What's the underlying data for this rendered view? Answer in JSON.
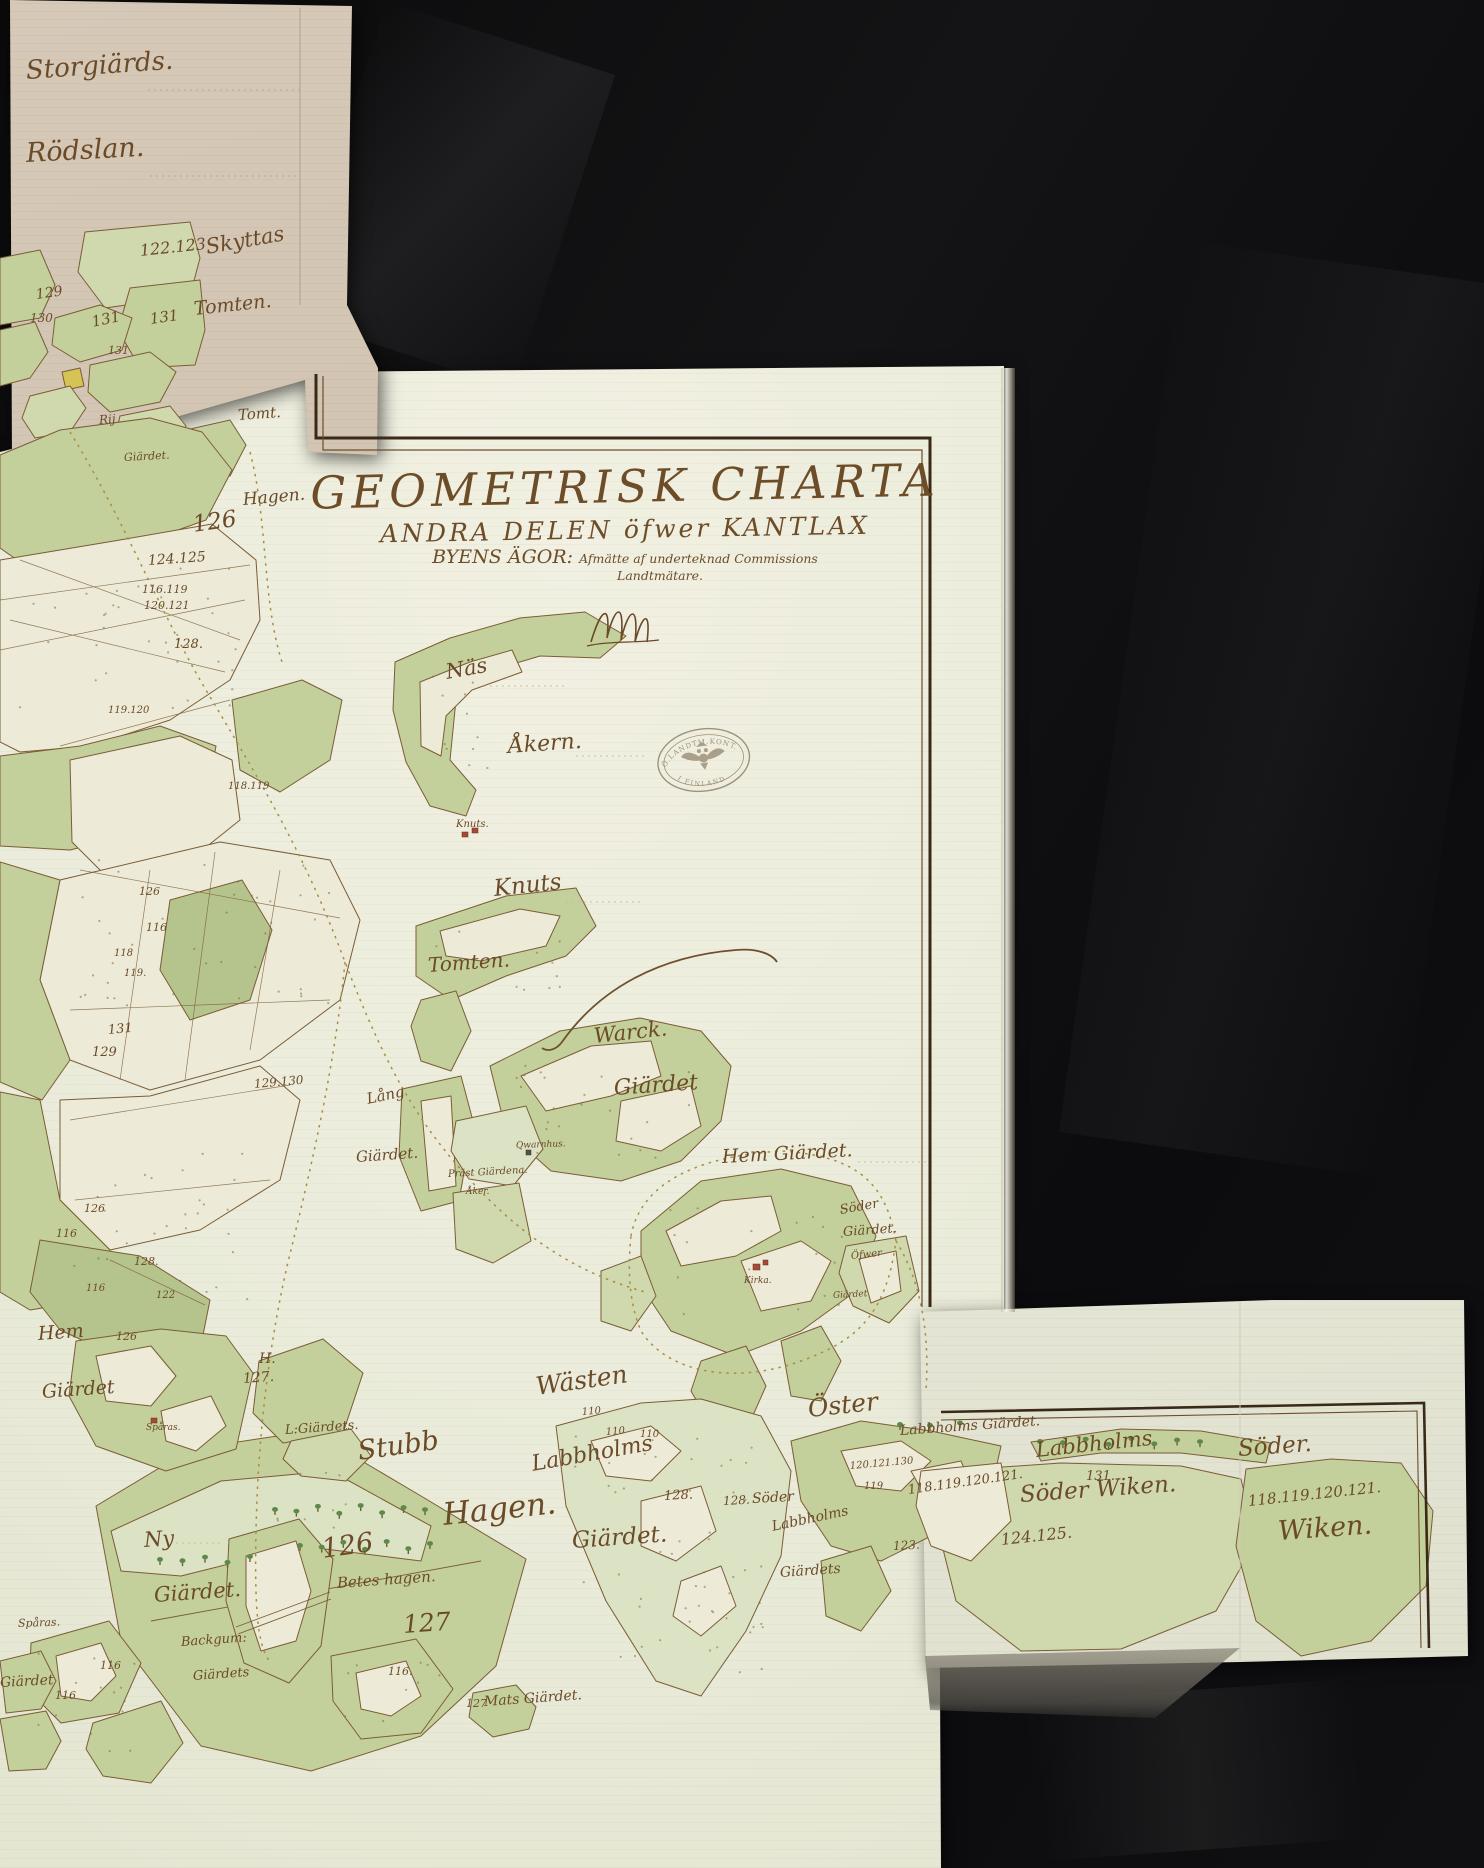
{
  "title_block": {
    "title": "GEOMETRISK CHARTA",
    "subtitle": "ANDRA DELEN öfwer KANTLAX",
    "line3_left": "BYENS ÄGOR:",
    "line3_right": "Afmätte af underteknad Commissions",
    "line4": "Landtmätare."
  },
  "stamp": {
    "arc_top": "Ö.LANDTM.KONT.",
    "arc_bottom": "I FINLAND"
  },
  "labels": [
    {
      "id": "storgiards",
      "t": "Storgiärds.",
      "x": 26,
      "y": 58,
      "s": 26,
      "r": -4
    },
    {
      "id": "rodslan",
      "t": "Rödslan.",
      "x": 26,
      "y": 140,
      "s": 27,
      "r": -3
    },
    {
      "id": "num-122-123",
      "t": "122.123",
      "x": 140,
      "y": 243,
      "s": 16,
      "r": -6
    },
    {
      "id": "skyttas",
      "t": "Skyttas",
      "x": 206,
      "y": 237,
      "s": 21,
      "r": -10
    },
    {
      "id": "num-129-tan",
      "t": "129",
      "x": 36,
      "y": 288,
      "s": 14,
      "r": -8
    },
    {
      "id": "num-130-tan",
      "t": "130",
      "x": 30,
      "y": 312,
      "s": 12,
      "r": 0
    },
    {
      "id": "num-131-a",
      "t": "131",
      "x": 92,
      "y": 315,
      "s": 15,
      "r": -12
    },
    {
      "id": "num-131-b",
      "t": "131",
      "x": 150,
      "y": 312,
      "s": 15,
      "r": -8
    },
    {
      "id": "num-131-c",
      "t": "131",
      "x": 108,
      "y": 345,
      "s": 11,
      "r": 0
    },
    {
      "id": "tomten-tan",
      "t": "Tomten.",
      "x": 194,
      "y": 300,
      "s": 19,
      "r": -6
    },
    {
      "id": "rij",
      "t": "Rij",
      "x": 99,
      "y": 414,
      "s": 12,
      "r": -5
    },
    {
      "id": "giardet-tan",
      "t": "Giärdet.",
      "x": 124,
      "y": 452,
      "s": 11,
      "r": -3
    },
    {
      "id": "tomt",
      "t": "Tomt.",
      "x": 238,
      "y": 408,
      "s": 15,
      "r": -4
    },
    {
      "id": "hagen-left",
      "t": "Hagen.",
      "x": 243,
      "y": 492,
      "s": 17,
      "r": -5
    },
    {
      "id": "num-126-big-cluster",
      "t": "126",
      "x": 193,
      "y": 514,
      "s": 23,
      "r": -8
    },
    {
      "id": "num-124-125",
      "t": "124.125",
      "x": 148,
      "y": 554,
      "s": 14,
      "r": -4
    },
    {
      "id": "num-116-119",
      "t": "116.119",
      "x": 142,
      "y": 584,
      "s": 11,
      "r": 0
    },
    {
      "id": "num-120-121",
      "t": "120.121",
      "x": 144,
      "y": 600,
      "s": 11,
      "r": 0
    },
    {
      "id": "num-128-c",
      "t": "128.",
      "x": 174,
      "y": 638,
      "s": 13,
      "r": 0
    },
    {
      "id": "num-119-120",
      "t": "119.120",
      "x": 108,
      "y": 706,
      "s": 10,
      "r": 0
    },
    {
      "id": "num-118-119",
      "t": "118.119",
      "x": 228,
      "y": 782,
      "s": 10,
      "r": 0
    },
    {
      "id": "num-126-b",
      "t": "126",
      "x": 139,
      "y": 886,
      "s": 11,
      "r": 0
    },
    {
      "id": "num-116-a",
      "t": "116",
      "x": 146,
      "y": 922,
      "s": 11,
      "r": 0
    },
    {
      "id": "num-118-a",
      "t": "118",
      "x": 114,
      "y": 949,
      "s": 10,
      "r": 0
    },
    {
      "id": "num-119-a",
      "t": "119.",
      "x": 124,
      "y": 969,
      "s": 10,
      "r": 0
    },
    {
      "id": "num-131-d",
      "t": "131",
      "x": 108,
      "y": 1024,
      "s": 13,
      "r": -5
    },
    {
      "id": "num-129-b",
      "t": "129",
      "x": 92,
      "y": 1046,
      "s": 13,
      "r": 0
    },
    {
      "id": "num-129-130",
      "t": "129.130",
      "x": 254,
      "y": 1078,
      "s": 12,
      "r": -5
    },
    {
      "id": "num-126-c",
      "t": "126",
      "x": 84,
      "y": 1203,
      "s": 11,
      "r": 0
    },
    {
      "id": "num-116-b",
      "t": "116",
      "x": 56,
      "y": 1228,
      "s": 11,
      "r": 0
    },
    {
      "id": "num-128-d",
      "t": "128.",
      "x": 134,
      "y": 1256,
      "s": 11,
      "r": 0
    },
    {
      "id": "num-116-c",
      "t": "116",
      "x": 86,
      "y": 1284,
      "s": 10,
      "r": 0
    },
    {
      "id": "num-122-a",
      "t": "122",
      "x": 156,
      "y": 1291,
      "s": 10,
      "r": 0
    },
    {
      "id": "num-126-d",
      "t": "126",
      "x": 116,
      "y": 1331,
      "s": 11,
      "r": 0
    },
    {
      "id": "nas",
      "t": "Näs",
      "x": 446,
      "y": 662,
      "s": 21,
      "r": -10
    },
    {
      "id": "akern",
      "t": "Åkern.",
      "x": 508,
      "y": 736,
      "s": 22,
      "r": -4
    },
    {
      "id": "knuts-small",
      "t": "Knuts.",
      "x": 456,
      "y": 820,
      "s": 10,
      "r": 0
    },
    {
      "id": "knuts",
      "t": "Knuts",
      "x": 494,
      "y": 878,
      "s": 23,
      "r": -6
    },
    {
      "id": "tomten-main",
      "t": "Tomten.",
      "x": 428,
      "y": 955,
      "s": 20,
      "r": -4
    },
    {
      "id": "warck",
      "t": "Warck.",
      "x": 594,
      "y": 1026,
      "s": 21,
      "r": -6
    },
    {
      "id": "warck-giardet",
      "t": "Giärdet",
      "x": 614,
      "y": 1078,
      "s": 22,
      "r": -4
    },
    {
      "id": "lang",
      "t": "Lång",
      "x": 367,
      "y": 1092,
      "s": 15,
      "r": -12
    },
    {
      "id": "lang-giardet",
      "t": "Giärdet.",
      "x": 356,
      "y": 1150,
      "s": 15,
      "r": -4
    },
    {
      "id": "qwarnhus",
      "t": "Qwarnhus.",
      "x": 516,
      "y": 1142,
      "s": 9,
      "r": -2
    },
    {
      "id": "prast-giardena",
      "t": "Präst Giärdena.",
      "x": 448,
      "y": 1170,
      "s": 10,
      "r": -3
    },
    {
      "id": "aker-small",
      "t": "Åker.",
      "x": 466,
      "y": 1188,
      "s": 9,
      "r": 0
    },
    {
      "id": "hem-giardet",
      "t": "Hem Giärdet.",
      "x": 722,
      "y": 1148,
      "s": 19,
      "r": -3
    },
    {
      "id": "soder-giardet-1",
      "t": "Söder",
      "x": 840,
      "y": 1204,
      "s": 13,
      "r": -10
    },
    {
      "id": "soder-giardet-2",
      "t": "Giärdet.",
      "x": 843,
      "y": 1226,
      "s": 13,
      "r": -4
    },
    {
      "id": "ofwer",
      "t": "Öfwer",
      "x": 851,
      "y": 1252,
      "s": 10,
      "r": -6
    },
    {
      "id": "ofwer-giardet",
      "t": "Giärdet",
      "x": 833,
      "y": 1292,
      "s": 9,
      "r": -3
    },
    {
      "id": "kirka",
      "t": "Kirka.",
      "x": 744,
      "y": 1277,
      "s": 9,
      "r": 0
    },
    {
      "id": "wasten",
      "t": "Wästen",
      "x": 536,
      "y": 1374,
      "s": 25,
      "r": -8
    },
    {
      "id": "oster",
      "t": "Öster",
      "x": 808,
      "y": 1396,
      "s": 25,
      "r": -6
    },
    {
      "id": "labbholms-w",
      "t": "Labbholms",
      "x": 532,
      "y": 1454,
      "s": 22,
      "r": -10
    },
    {
      "id": "labbholms-w-giardet",
      "t": "Giärdet.",
      "x": 572,
      "y": 1530,
      "s": 23,
      "r": -4
    },
    {
      "id": "soder-mid",
      "t": "Söder",
      "x": 752,
      "y": 1492,
      "s": 14,
      "r": -3
    },
    {
      "id": "labbholms-mid",
      "t": "Labbholms",
      "x": 772,
      "y": 1520,
      "s": 14,
      "r": -12
    },
    {
      "id": "giardets-mid",
      "t": "Giärdets",
      "x": 780,
      "y": 1566,
      "s": 14,
      "r": -4
    },
    {
      "id": "num-128-a",
      "t": "128.",
      "x": 664,
      "y": 1490,
      "s": 13,
      "r": -3
    },
    {
      "id": "num-128-b",
      "t": "128.",
      "x": 723,
      "y": 1495,
      "s": 12,
      "r": -3
    },
    {
      "id": "num-123-a",
      "t": "123.",
      "x": 893,
      "y": 1540,
      "s": 12,
      "r": -3
    },
    {
      "id": "num-110-a",
      "t": "110",
      "x": 582,
      "y": 1408,
      "s": 10,
      "r": -5
    },
    {
      "id": "num-110-b",
      "t": "110",
      "x": 606,
      "y": 1428,
      "s": 10,
      "r": -5
    },
    {
      "id": "num-110-c",
      "t": "110",
      "x": 640,
      "y": 1430,
      "s": 10,
      "r": 0
    },
    {
      "id": "num-oster-1",
      "t": "120.121.130",
      "x": 850,
      "y": 1462,
      "s": 10,
      "r": -5
    },
    {
      "id": "num-oster-2",
      "t": "119",
      "x": 864,
      "y": 1482,
      "s": 10,
      "r": 0
    },
    {
      "id": "stubb",
      "t": "Stubb",
      "x": 358,
      "y": 1438,
      "s": 27,
      "r": -8
    },
    {
      "id": "l-giardets",
      "t": "L:Giärdets.",
      "x": 285,
      "y": 1424,
      "s": 13,
      "r": -4
    },
    {
      "id": "hagen-big",
      "t": "Hagen.",
      "x": 443,
      "y": 1500,
      "s": 31,
      "r": -6
    },
    {
      "id": "num-126-big",
      "t": "126",
      "x": 322,
      "y": 1536,
      "s": 27,
      "r": -8
    },
    {
      "id": "betes-hagen",
      "t": "Betes hagen.",
      "x": 337,
      "y": 1576,
      "s": 15,
      "r": -4
    },
    {
      "id": "num-127-big",
      "t": "127",
      "x": 403,
      "y": 1612,
      "s": 25,
      "r": -4
    },
    {
      "id": "hem-2",
      "t": "Hem",
      "x": 38,
      "y": 1325,
      "s": 19,
      "r": -4
    },
    {
      "id": "hem-2-giardet",
      "t": "Giärdet",
      "x": 42,
      "y": 1383,
      "s": 19,
      "r": -4
    },
    {
      "id": "sparas-1",
      "t": "Spåras.",
      "x": 146,
      "y": 1424,
      "s": 9,
      "r": 0
    },
    {
      "id": "h-mark",
      "t": "H.",
      "x": 259,
      "y": 1352,
      "s": 14,
      "r": 0
    },
    {
      "id": "num-127-c",
      "t": "127.",
      "x": 243,
      "y": 1372,
      "s": 14,
      "r": -4
    },
    {
      "id": "ny",
      "t": "Ny",
      "x": 144,
      "y": 1530,
      "s": 21,
      "r": -4
    },
    {
      "id": "ny-giardet",
      "t": "Giärdet.",
      "x": 154,
      "y": 1585,
      "s": 21,
      "r": -4
    },
    {
      "id": "sparas-2",
      "t": "Spåras.",
      "x": 18,
      "y": 1618,
      "s": 11,
      "r": -2
    },
    {
      "id": "backgum",
      "t": "Backgum:",
      "x": 181,
      "y": 1636,
      "s": 13,
      "r": -4
    },
    {
      "id": "backgum-giardets",
      "t": "Giärdets",
      "x": 193,
      "y": 1670,
      "s": 13,
      "r": -4
    },
    {
      "id": "backgum-num",
      "t": "116.",
      "x": 388,
      "y": 1666,
      "s": 11,
      "r": 0
    },
    {
      "id": "num-116-d",
      "t": "116",
      "x": 100,
      "y": 1660,
      "s": 11,
      "r": 0
    },
    {
      "id": "num-116-e",
      "t": "116",
      "x": 55,
      "y": 1690,
      "s": 11,
      "r": 0
    },
    {
      "id": "giardet-bottom-left",
      "t": "Giärdet",
      "x": 0,
      "y": 1676,
      "s": 14,
      "r": -3
    },
    {
      "id": "mats-giardet",
      "t": "Mats Giärdet.",
      "x": 484,
      "y": 1695,
      "s": 14,
      "r": -4
    },
    {
      "id": "num-127-d",
      "t": "127",
      "x": 466,
      "y": 1698,
      "s": 11,
      "r": 0
    },
    {
      "id": "labbholms-giardet-right",
      "t": "Labbholms Giärdet.",
      "x": 900,
      "y": 1424,
      "s": 14,
      "r": -4
    },
    {
      "id": "labbholms-right",
      "t": "Labbholms",
      "x": 1036,
      "y": 1440,
      "s": 21,
      "r": -6
    },
    {
      "id": "num-131-right",
      "t": "131.",
      "x": 1086,
      "y": 1470,
      "s": 13,
      "r": 0
    },
    {
      "id": "soder-wiken",
      "t": "Söder Wiken.",
      "x": 1020,
      "y": 1484,
      "s": 23,
      "r": -4
    },
    {
      "id": "num-124-125-right",
      "t": "124.125.",
      "x": 1001,
      "y": 1532,
      "s": 16,
      "r": -6
    },
    {
      "id": "num-118-121-left",
      "t": "118.119.120.121.",
      "x": 908,
      "y": 1484,
      "s": 13,
      "r": -8
    },
    {
      "id": "soder-right",
      "t": "Söder.",
      "x": 1238,
      "y": 1438,
      "s": 23,
      "r": -4
    },
    {
      "id": "num-118-121-right",
      "t": "118.119.120.121.",
      "x": 1248,
      "y": 1494,
      "s": 15,
      "r": -6
    },
    {
      "id": "wiken-right",
      "t": "Wiken.",
      "x": 1278,
      "y": 1518,
      "s": 27,
      "r": -4
    }
  ]
}
